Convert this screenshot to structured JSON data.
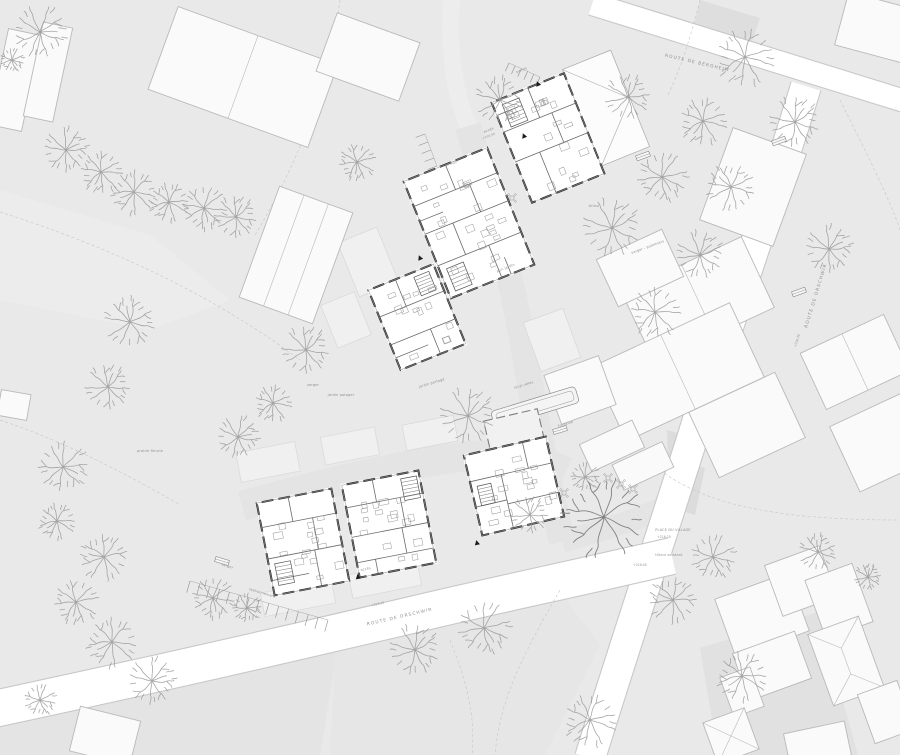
{
  "meta": {
    "title": "Architectural site plan — ground floor masterplan",
    "canvas": {
      "w": 900,
      "h": 755
    }
  },
  "colors": {
    "ground": "#e9e9e9",
    "court": "#e4e4e4",
    "lane": "#ededed",
    "road_fill": "#ffffff",
    "road_casing": "#c8c8c8",
    "context_fill": "#fafafa",
    "context_stroke": "#b9b9b9",
    "plot_fill": "#f0f0f0",
    "plot_stroke": "#d8d8d8",
    "patch_dark": "#dcdcdc",
    "wall": "#2d2d2d",
    "partition": "#6b6b6b",
    "furniture": "#979797",
    "tree": "#98989b",
    "tree_dark": "#7c7c7c",
    "dashed": "#c6c6c6",
    "text": "#8c8c8c",
    "marker": "#1c1c1c"
  },
  "streets": [
    {
      "text": "ROUTE DE ORSCHWIR",
      "x": 400,
      "y": 618,
      "r": -13
    },
    {
      "text": "ROUTE DE ORSCHWIR",
      "x": 817,
      "y": 296,
      "r": -73
    },
    {
      "text": "ROUTE DE BERGHEIM",
      "x": 697,
      "y": 64,
      "r": 13
    }
  ],
  "labels": [
    {
      "text": "verger",
      "x": 313,
      "y": 386,
      "r": 0,
      "k": "tiny"
    },
    {
      "text": "jardin potager",
      "x": 341,
      "y": 396,
      "r": 0,
      "k": "tiny"
    },
    {
      "text": "jardin partagé",
      "x": 432,
      "y": 384,
      "r": -17,
      "k": "tiny"
    },
    {
      "text": "potager",
      "x": 452,
      "y": 164,
      "r": -22,
      "k": "tiny"
    },
    {
      "text": "parvis",
      "x": 522,
      "y": 71,
      "r": -22,
      "k": "tiny"
    },
    {
      "text": "verger - pommiers",
      "x": 648,
      "y": 248,
      "r": -20,
      "k": "tiny"
    },
    {
      "text": "tilleul",
      "x": 594,
      "y": 207,
      "r": 0,
      "k": "tiny"
    },
    {
      "text": "PLACE DU VILLAGE",
      "x": 673,
      "y": 531,
      "r": 0,
      "k": "tiny"
    },
    {
      "text": "+216.20",
      "x": 664,
      "y": 538,
      "r": 0,
      "k": "elev"
    },
    {
      "text": "tilleul existant",
      "x": 669,
      "y": 556,
      "r": 0,
      "k": "tiny"
    },
    {
      "text": "fontaine",
      "x": 566,
      "y": 425,
      "r": -17,
      "k": "tiny"
    },
    {
      "text": "local vélos",
      "x": 524,
      "y": 386,
      "r": -17,
      "k": "tiny"
    },
    {
      "text": "stationnement",
      "x": 262,
      "y": 594,
      "r": 17,
      "k": "tiny"
    },
    {
      "text": "verger",
      "x": 227,
      "y": 567,
      "r": 17,
      "k": "tiny"
    },
    {
      "text": "abri jardin",
      "x": 506,
      "y": 269,
      "r": -22,
      "k": "tiny"
    },
    {
      "text": "accès",
      "x": 489,
      "y": 131,
      "r": -22,
      "k": "tiny"
    },
    {
      "text": "accès",
      "x": 366,
      "y": 570,
      "r": -11,
      "k": "tiny"
    },
    {
      "text": "prairie fleurie",
      "x": 150,
      "y": 452,
      "r": 0,
      "k": "tiny"
    },
    {
      "text": "+216.10",
      "x": 378,
      "y": 605,
      "r": -13,
      "k": "elev"
    },
    {
      "text": "+216.30",
      "x": 798,
      "y": 341,
      "r": -73,
      "k": "elev"
    },
    {
      "text": "+216.40",
      "x": 640,
      "y": 566,
      "r": 0,
      "k": "elev"
    },
    {
      "text": "+216.50",
      "x": 489,
      "y": 137,
      "r": -22,
      "k": "elev"
    }
  ],
  "entry_markers": [
    {
      "x": 538,
      "y": 84,
      "r": -22
    },
    {
      "x": 524,
      "y": 136,
      "r": -22
    },
    {
      "x": 420,
      "y": 258,
      "r": -22
    },
    {
      "x": 358,
      "y": 577,
      "r": -11
    },
    {
      "x": 477,
      "y": 543,
      "r": -13
    }
  ],
  "roads": [
    {
      "d": "M592,4 L914,104",
      "w": 22
    },
    {
      "d": "M806,86 C772,198 736,300 701,410 C672,505 630,628 590,758",
      "w": 30
    },
    {
      "d": "M-20,712 C140,678 280,646 420,613 C500,594 560,582 672,556",
      "w": 36
    }
  ],
  "bands": [
    {
      "d": "M452,-6 C447,50 455,96 470,130",
      "w": 17,
      "c": "#ededed"
    },
    {
      "d": "M468,126 C492,210 512,280 522,338 C532,400 546,470 562,542",
      "w": 26,
      "c": "#e4e4e4"
    },
    {
      "d": "M242,506 C330,481 420,461 470,456 C505,452 535,458 566,472",
      "w": 30,
      "c": "#e4e4e4"
    },
    {
      "d": "M562,542 C600,530 640,520 668,505",
      "w": 22,
      "c": "#e4e4e4"
    }
  ],
  "patches": [
    {
      "pts": "667,430 707,442 700,465 668,458",
      "f": "#dcdcdc"
    },
    {
      "pts": "668,458 705,468 695,515 662,505",
      "f": "#dcdcdc"
    },
    {
      "pts": "700,648 818,612 858,755 718,755",
      "f": "#e1e1e1"
    },
    {
      "pts": "0,700 200,660 340,634 320,755 0,755",
      "f": "#e4e4e4"
    },
    {
      "pts": "336,640 560,592 600,645 545,755 330,755",
      "f": "#e6e6e6"
    },
    {
      "pts": "700,0 760,18 752,42 694,26",
      "f": "#dedede"
    },
    {
      "pts": "0,190 150,235 230,300 150,330 0,300",
      "f": "#ececec"
    }
  ],
  "plots": [
    {
      "x": 298,
      "y": 598,
      "w": 72,
      "h": 24,
      "r": -11
    },
    {
      "x": 385,
      "y": 580,
      "w": 70,
      "h": 24,
      "r": -11
    },
    {
      "x": 268,
      "y": 462,
      "w": 60,
      "h": 30,
      "r": -11
    },
    {
      "x": 350,
      "y": 446,
      "w": 55,
      "h": 28,
      "r": -11
    },
    {
      "x": 430,
      "y": 433,
      "w": 52,
      "h": 26,
      "r": -11
    },
    {
      "x": 368,
      "y": 262,
      "w": 42,
      "h": 58,
      "r": -22
    },
    {
      "x": 346,
      "y": 320,
      "w": 36,
      "h": 46,
      "r": -22
    },
    {
      "x": 552,
      "y": 340,
      "w": 42,
      "h": 52,
      "r": -20
    }
  ],
  "context_buildings": [
    {
      "x": 243,
      "y": 77,
      "w": 170,
      "h": 88,
      "r": 20,
      "div": 1
    },
    {
      "x": 15,
      "y": 80,
      "w": 34,
      "h": 98,
      "r": 12,
      "div": 0
    },
    {
      "x": 48,
      "y": 72,
      "w": 30,
      "h": 96,
      "r": 12,
      "div": 0
    },
    {
      "x": 368,
      "y": 57,
      "w": 88,
      "h": 62,
      "r": 20,
      "div": 0
    },
    {
      "x": 296,
      "y": 255,
      "w": 78,
      "h": 118,
      "r": 20,
      "div": 2
    },
    {
      "x": 753,
      "y": 187,
      "w": 78,
      "h": 98,
      "r": 20,
      "div": 0
    },
    {
      "x": 878,
      "y": 28,
      "w": 75,
      "h": 55,
      "r": 15,
      "div": 0
    },
    {
      "x": 698,
      "y": 300,
      "w": 132,
      "h": 78,
      "r": -25,
      "div": 1
    },
    {
      "x": 678,
      "y": 372,
      "w": 152,
      "h": 82,
      "r": -25,
      "div": 1
    },
    {
      "x": 747,
      "y": 425,
      "w": 95,
      "h": 72,
      "r": -25,
      "div": 0
    },
    {
      "x": 640,
      "y": 268,
      "w": 72,
      "h": 52,
      "r": -25,
      "div": 0
    },
    {
      "x": 855,
      "y": 362,
      "w": 92,
      "h": 62,
      "r": -25,
      "div": 1
    },
    {
      "x": 882,
      "y": 442,
      "w": 82,
      "h": 72,
      "r": -25,
      "div": 0
    },
    {
      "x": 612,
      "y": 446,
      "w": 58,
      "h": 30,
      "r": -25,
      "div": 0
    },
    {
      "x": 643,
      "y": 466,
      "w": 55,
      "h": 28,
      "r": -25,
      "div": 0
    },
    {
      "x": 580,
      "y": 390,
      "w": 58,
      "h": 52,
      "r": -20,
      "div": 0
    },
    {
      "x": 762,
      "y": 615,
      "w": 78,
      "h": 62,
      "r": -20,
      "div": 0
    },
    {
      "x": 801,
      "y": 581,
      "w": 58,
      "h": 54,
      "r": -20,
      "div": 0
    },
    {
      "x": 839,
      "y": 601,
      "w": 50,
      "h": 62,
      "r": -20,
      "div": 0
    },
    {
      "x": 772,
      "y": 666,
      "w": 66,
      "h": 50,
      "r": -20,
      "div": 0
    },
    {
      "x": 846,
      "y": 661,
      "w": 54,
      "h": 76,
      "r": -20,
      "div": 0,
      "roof": "hip"
    },
    {
      "x": 886,
      "y": 712,
      "w": 42,
      "h": 52,
      "r": -20,
      "div": 0
    },
    {
      "x": 742,
      "y": 692,
      "w": 32,
      "h": 42,
      "r": -20,
      "div": 0
    },
    {
      "x": 731,
      "y": 736,
      "w": 44,
      "h": 44,
      "r": -20,
      "div": 0,
      "roof": "x"
    },
    {
      "x": 818,
      "y": 747,
      "w": 62,
      "h": 40,
      "r": -12,
      "div": 0
    },
    {
      "x": 105,
      "y": 736,
      "w": 62,
      "h": 46,
      "r": 14,
      "div": 0
    },
    {
      "x": 14,
      "y": 405,
      "w": 30,
      "h": 26,
      "r": 10,
      "div": 0
    }
  ],
  "plan_buildings": [
    {
      "x": 548,
      "y": 138,
      "r": -22,
      "w": 78,
      "h": 108,
      "seed": 1,
      "partitions": [
        [
          -39,
          -22,
          39,
          -22
        ],
        [
          -39,
          10,
          39,
          10
        ],
        [
          0,
          -54,
          0,
          -22
        ],
        [
          -13,
          10,
          -13,
          54
        ],
        [
          13,
          -22,
          13,
          10
        ],
        [
          -39,
          -40,
          -16,
          -40
        ]
      ],
      "stair": [
        -30,
        -48,
        18,
        24
      ],
      "roof": {
        "x": 39,
        "y": -58,
        "w": 52,
        "h": 104,
        "apex": [
          91,
          -6
        ]
      }
    },
    {
      "x": 469,
      "y": 223,
      "r": -22,
      "w": 90,
      "h": 126,
      "seed": 2,
      "partitions": [
        [
          -45,
          -36,
          45,
          -36
        ],
        [
          -45,
          -6,
          45,
          -6
        ],
        [
          -45,
          28,
          45,
          28
        ],
        [
          0,
          -63,
          0,
          -36
        ],
        [
          -15,
          -6,
          -15,
          28
        ],
        [
          15,
          -36,
          15,
          -6
        ],
        [
          10,
          28,
          10,
          63
        ],
        [
          -45,
          -20,
          -20,
          -20
        ],
        [
          20,
          45,
          20,
          63
        ]
      ],
      "stair": [
        -38,
        34,
        18,
        24
      ]
    },
    {
      "x": 417,
      "y": 317,
      "r": -22,
      "w": 70,
      "h": 86,
      "seed": 3,
      "partitions": [
        [
          -35,
          -14,
          35,
          -14
        ],
        [
          -35,
          16,
          35,
          16
        ],
        [
          -6,
          -43,
          -6,
          -14
        ],
        [
          8,
          16,
          8,
          43
        ],
        [
          -35,
          30,
          0,
          30
        ]
      ],
      "stair": [
        12,
        -38,
        16,
        20
      ]
    },
    {
      "x": 303,
      "y": 542,
      "r": -11,
      "w": 76,
      "h": 94,
      "seed": 4,
      "partitions": [
        [
          -38,
          -22,
          38,
          -22
        ],
        [
          -38,
          10,
          38,
          10
        ],
        [
          -6,
          -47,
          -6,
          -22
        ],
        [
          10,
          10,
          10,
          47
        ],
        [
          -38,
          32,
          0,
          32
        ],
        [
          14,
          -22,
          14,
          10
        ]
      ],
      "stair": [
        -32,
        16,
        16,
        22
      ]
    },
    {
      "x": 389,
      "y": 524,
      "r": -11,
      "w": 78,
      "h": 94,
      "seed": 5,
      "partitions": [
        [
          -39,
          -24,
          39,
          -24
        ],
        [
          -39,
          6,
          39,
          6
        ],
        [
          -39,
          32,
          39,
          32
        ],
        [
          -8,
          -47,
          -8,
          -24
        ],
        [
          12,
          6,
          12,
          32
        ],
        [
          -20,
          32,
          -20,
          47
        ],
        [
          16,
          -24,
          16,
          6
        ]
      ],
      "stair": [
        20,
        -42,
        16,
        22
      ]
    },
    {
      "x": 514,
      "y": 486,
      "r": -13,
      "w": 84,
      "h": 82,
      "seed": 6,
      "partitions": [
        [
          -42,
          -14,
          42,
          -14
        ],
        [
          -10,
          -14,
          -10,
          41
        ],
        [
          -10,
          16,
          42,
          16
        ],
        [
          18,
          -41,
          18,
          -14
        ],
        [
          -42,
          12,
          -10,
          12
        ]
      ],
      "stair": [
        -36,
        -8,
        14,
        20
      ],
      "court": {
        "x": -15,
        "y": -70,
        "w": 55,
        "h": 30
      }
    }
  ],
  "trees": [
    [
      40,
      32,
      1.0
    ],
    [
      12,
      60,
      0.45
    ],
    [
      66,
      150,
      0.85
    ],
    [
      101,
      172,
      0.8
    ],
    [
      134,
      192,
      0.85
    ],
    [
      169,
      202,
      0.75
    ],
    [
      204,
      208,
      0.85
    ],
    [
      236,
      217,
      0.8
    ],
    [
      130,
      322,
      0.95
    ],
    [
      108,
      387,
      0.85
    ],
    [
      63,
      467,
      0.95
    ],
    [
      57,
      521,
      0.7
    ],
    [
      104,
      557,
      0.9
    ],
    [
      76,
      602,
      0.85
    ],
    [
      112,
      642,
      0.95
    ],
    [
      152,
      681,
      0.9
    ],
    [
      40,
      700,
      0.6
    ],
    [
      213,
      598,
      0.8
    ],
    [
      247,
      608,
      0.55
    ],
    [
      238,
      437,
      0.8
    ],
    [
      273,
      403,
      0.7
    ],
    [
      306,
      350,
      0.9
    ],
    [
      357,
      162,
      0.7
    ],
    [
      500,
      100,
      0.9
    ],
    [
      628,
      97,
      0.85
    ],
    [
      703,
      121,
      0.9
    ],
    [
      662,
      177,
      0.95
    ],
    [
      612,
      228,
      1.1
    ],
    [
      700,
      255,
      0.9
    ],
    [
      655,
      312,
      0.95
    ],
    [
      745,
      57,
      1.1
    ],
    [
      795,
      122,
      0.95
    ],
    [
      731,
      187,
      0.9
    ],
    [
      829,
      249,
      0.9
    ],
    [
      468,
      416,
      1.05
    ],
    [
      530,
      515,
      0.7
    ],
    [
      585,
      477,
      0.55
    ],
    [
      604,
      517,
      1.55,
      1
    ],
    [
      415,
      650,
      0.95
    ],
    [
      484,
      628,
      1.0
    ],
    [
      590,
      720,
      1.0
    ],
    [
      673,
      600,
      0.9
    ],
    [
      713,
      557,
      0.85
    ],
    [
      742,
      676,
      0.95
    ],
    [
      818,
      552,
      0.7
    ],
    [
      868,
      577,
      0.5
    ]
  ],
  "parking_strips": [
    {
      "x1": 190,
      "y1": 581,
      "x2": 328,
      "y2": 620,
      "n": 15,
      "len": 12
    },
    {
      "x1": 425,
      "y1": 134,
      "x2": 443,
      "y2": 182,
      "n": 7,
      "len": 10
    },
    {
      "x1": 509,
      "y1": 63,
      "x2": 540,
      "y2": 77,
      "n": 6,
      "len": 9
    }
  ],
  "benches": [
    {
      "x": 222,
      "y": 561,
      "r": 17
    },
    {
      "x": 560,
      "y": 430,
      "r": -17
    },
    {
      "x": 779,
      "y": 141,
      "r": -20
    },
    {
      "x": 799,
      "y": 292,
      "r": -20
    },
    {
      "x": 643,
      "y": 156,
      "r": -20
    }
  ],
  "tables": [
    [
      545,
      448
    ],
    [
      551,
      484
    ],
    [
      564,
      493
    ],
    [
      608,
      478
    ],
    [
      621,
      484
    ],
    [
      633,
      489
    ],
    [
      500,
      207
    ],
    [
      512,
      198
    ],
    [
      389,
      327
    ],
    [
      397,
      341
    ],
    [
      410,
      355
    ],
    [
      536,
      440
    ]
  ],
  "planter": {
    "x": 535,
    "y": 407,
    "r": -17,
    "w": 88,
    "h": 17
  },
  "dashes": [
    "M0,212 C120,250 220,300 300,360",
    "M340,0 C330,80 300,160 255,235",
    "M660,470 C700,500 760,520 900,520",
    "M560,590 C520,660 500,700 495,755",
    "M0,420 C60,440 120,470 180,505",
    "M700,0 C690,40 680,70 668,95",
    "M450,640 C470,690 475,720 472,755",
    "M840,100 C870,160 890,200 900,230"
  ]
}
